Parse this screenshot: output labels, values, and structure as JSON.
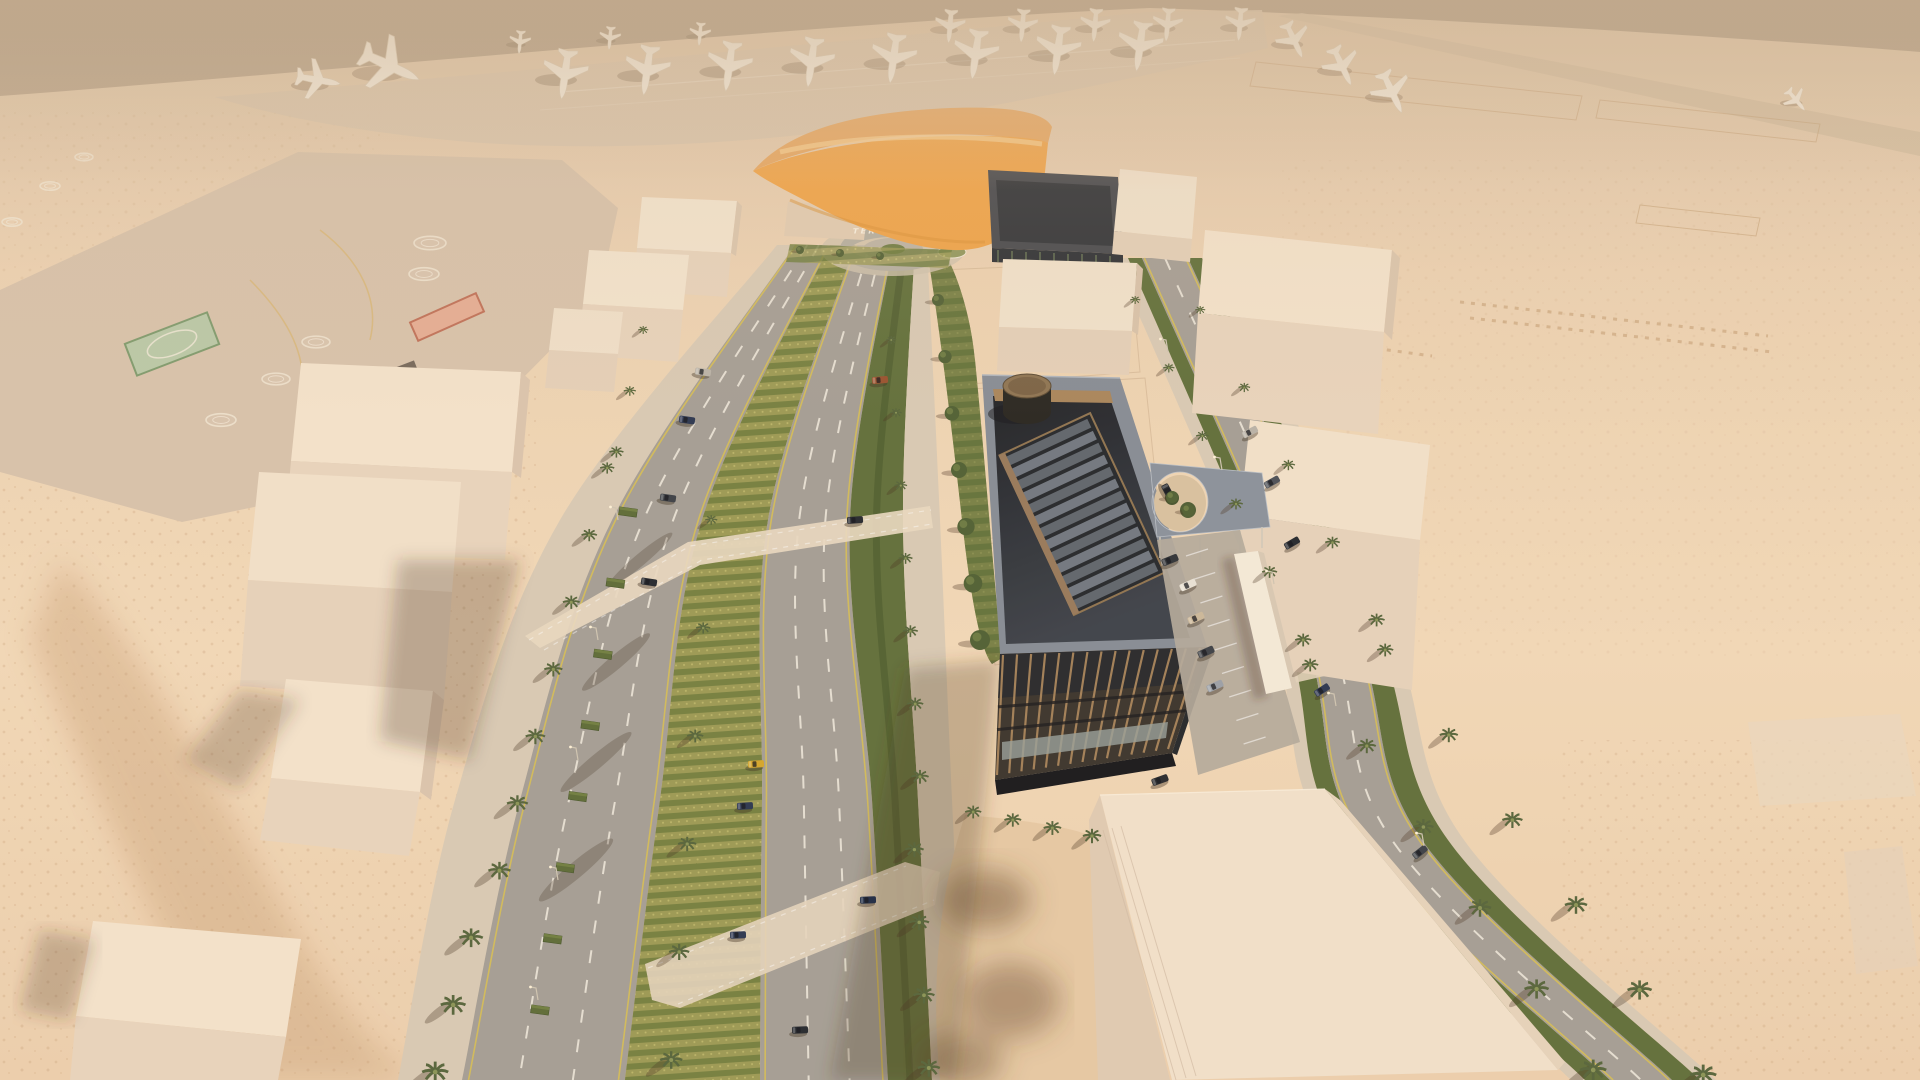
{
  "scene": {
    "description": "Aerial 3D architectural rendering of a desert VIP-terminal district: airport apron with parked aircraft along the horizon, orange VIP terminal canopy, landscaped boulevard with traffic, dark office building with rooftop drum and skylight, helipad apron, and untextured cream massing blocks.",
    "signage": {
      "vip_line1": "VIP",
      "vip_line2": "TERMINAL"
    },
    "palette": {
      "sky_top": "#a18e78",
      "sky_horizon": "#dbc2a4",
      "sand": "#ecd2b2",
      "sand_bright": "#f2d8b8",
      "sand_scrub": "#c79e74",
      "apron": "#d9c5ae",
      "apron_left": "#d7c2ab",
      "road": "#a49e95",
      "road_line_yellow": "#d9c050",
      "road_line_white": "#f5efe2",
      "median_green": "#97914f",
      "median_row_dark": "#6e7c3c",
      "hedge_green": "#5f6e39",
      "palm_green": "#55643a",
      "massing_top": "#f3e4ce",
      "massing_face": "#e7d3bc",
      "massing_side": "#dbc5ad",
      "dark_building": "#39332c",
      "dark_roof": "#23262b",
      "roof_metal": "#858c95",
      "bronze": "#a8845a",
      "glass": "#99a3ad",
      "canopy_orange": "#f0a449",
      "canopy_orange_back": "#e8a65e",
      "canopy_highlight": "#f8cd8e",
      "plane_white": "#f6efe3",
      "concrete": "#d8cab5",
      "shadow": "rgba(70,50,32,0.32)"
    },
    "airport": {
      "plane_rows": [
        {
          "from": [
            565,
            74
          ],
          "to": [
            1140,
            46
          ],
          "count": 8,
          "rot": 188,
          "scale": 1.5
        },
        {
          "from": [
            950,
            26
          ],
          "to": [
            1240,
            24
          ],
          "count": 5,
          "rot": 185,
          "scale": 1.0
        },
        {
          "from": [
            520,
            42
          ],
          "to": [
            700,
            34
          ],
          "count": 3,
          "rot": 185,
          "scale": 0.7
        }
      ],
      "plane_singles": [
        {
          "x": 390,
          "y": 66,
          "rot": 115,
          "scale": 1.9
        },
        {
          "x": 318,
          "y": 80,
          "rot": 100,
          "scale": 1.35
        },
        {
          "x": 1294,
          "y": 40,
          "rot": 155,
          "scale": 1.15
        },
        {
          "x": 1342,
          "y": 66,
          "rot": 155,
          "scale": 1.25
        },
        {
          "x": 1392,
          "y": 92,
          "rot": 155,
          "scale": 1.35
        },
        {
          "x": 1796,
          "y": 100,
          "rot": 140,
          "scale": 0.8
        }
      ]
    },
    "helipads": {
      "circles": [
        [
          430,
          243,
          16
        ],
        [
          424,
          274,
          15
        ],
        [
          316,
          342,
          14
        ],
        [
          276,
          379,
          14
        ],
        [
          221,
          420,
          15
        ],
        [
          84,
          157,
          9
        ],
        [
          50,
          186,
          10
        ],
        [
          12,
          222,
          10
        ]
      ],
      "green_square": {
        "x": 172,
        "y": 344,
        "w": 88,
        "h": 34,
        "rot": -21
      },
      "red_pad": {
        "x": 447,
        "y": 317,
        "w": 72,
        "h": 20,
        "rot": -24
      }
    },
    "boulevard": {
      "anchors_y": [
        245,
        520,
        800,
        1080
      ],
      "edges": {
        "e0": [
          777,
          560,
          455,
          398
        ],
        "e1": [
          795,
          612,
          520,
          462
        ],
        "e2": [
          830,
          702,
          660,
          625
        ],
        "e3": [
          855,
          768,
          762,
          760
        ],
        "e4": [
          893,
          850,
          872,
          888
        ],
        "e5": [
          915,
          903,
          918,
          932
        ],
        "e6": [
          927,
          940,
          952,
          966
        ]
      },
      "lanesA": [
        0.35,
        0.68
      ],
      "lanesB": [
        0.38,
        0.7
      ]
    },
    "right_avenue": {
      "anchors_y": [
        258,
        620,
        840,
        1080
      ],
      "edges": {
        "r0": [
          1128,
          1282,
          1342,
          1585
        ],
        "r1": [
          1142,
          1300,
          1362,
          1610
        ],
        "r2": [
          1188,
          1352,
          1422,
          1672
        ],
        "r3": [
          1202,
          1372,
          1448,
          1700
        ]
      }
    },
    "vehicles": {
      "street_cars": [
        {
          "x": 703,
          "y": 372,
          "rot": 8,
          "color": "#b9b3a8"
        },
        {
          "x": 687,
          "y": 420,
          "rot": 8,
          "color": "#2a3550"
        },
        {
          "x": 668,
          "y": 498,
          "rot": 8,
          "color": "#3a3f46"
        },
        {
          "x": 649,
          "y": 582,
          "rot": 9,
          "color": "#23272e"
        },
        {
          "x": 880,
          "y": 380,
          "rot": -5,
          "color": "#97502d"
        },
        {
          "x": 855,
          "y": 520,
          "rot": -4,
          "color": "#23272e"
        },
        {
          "x": 756,
          "y": 764,
          "rot": -3,
          "color": "#d4a62a"
        },
        {
          "x": 745,
          "y": 806,
          "rot": -3,
          "color": "#2a3550"
        },
        {
          "x": 738,
          "y": 935,
          "rot": -2,
          "color": "#2a3550"
        },
        {
          "x": 868,
          "y": 900,
          "rot": -2,
          "color": "#1d2a44"
        },
        {
          "x": 800,
          "y": 1030,
          "rot": -2,
          "color": "#23272e"
        },
        {
          "x": 1250,
          "y": 432,
          "rot": -27,
          "color": "#b9b3a8"
        },
        {
          "x": 1272,
          "y": 482,
          "rot": -29,
          "color": "#4a4f57"
        },
        {
          "x": 1292,
          "y": 543,
          "rot": -30,
          "color": "#23272e"
        },
        {
          "x": 1322,
          "y": 690,
          "rot": -33,
          "color": "#2a3550"
        },
        {
          "x": 1420,
          "y": 852,
          "rot": -38,
          "color": "#3a3f46"
        }
      ],
      "parked_cars": [
        {
          "x": 1188,
          "y": 585,
          "rot": -24,
          "color": "#e8e2d6"
        },
        {
          "x": 1196,
          "y": 618,
          "rot": -24,
          "color": "#cbb89a"
        },
        {
          "x": 1206,
          "y": 652,
          "rot": -24,
          "color": "#3c4046"
        },
        {
          "x": 1215,
          "y": 686,
          "rot": -24,
          "color": "#9aa0a8"
        },
        {
          "x": 1170,
          "y": 560,
          "rot": -22,
          "color": "#2e3237"
        },
        {
          "x": 1160,
          "y": 780,
          "rot": -20,
          "color": "#26292e"
        },
        {
          "x": 1168,
          "y": 492,
          "rot": 62,
          "color": "#23262b"
        }
      ]
    },
    "vegetation": {
      "palm_rows": [
        {
          "from": [
            648,
            330
          ],
          "to": [
            618,
            452
          ],
          "count": 3,
          "s0": 5,
          "s1": 7
        },
        {
          "from": [
            612,
            468
          ],
          "to": [
            436,
            1072
          ],
          "count": 10,
          "s0": 7,
          "s1": 13
        },
        {
          "from": [
            716,
            520
          ],
          "to": [
            668,
            1060
          ],
          "count": 6,
          "s0": 6,
          "s1": 11
        },
        {
          "from": [
            896,
            340
          ],
          "to": [
            928,
            1068
          ],
          "count": 11,
          "s0": 5,
          "s1": 11
        },
        {
          "from": [
            1140,
            300
          ],
          "to": [
            1300,
            640
          ],
          "count": 6,
          "s0": 5,
          "s1": 8
        },
        {
          "from": [
            1315,
            665
          ],
          "to": [
            1590,
            1070
          ],
          "count": 6,
          "s0": 8,
          "s1": 13
        },
        {
          "from": [
            1205,
            310
          ],
          "to": [
            1375,
            620
          ],
          "count": 5,
          "s0": 5,
          "s1": 8
        },
        {
          "from": [
            1390,
            650
          ],
          "to": [
            1700,
            1075
          ],
          "count": 6,
          "s0": 8,
          "s1": 13
        },
        {
          "from": [
            978,
            812
          ],
          "to": [
            1092,
            836
          ],
          "count": 4,
          "s0": 8,
          "s1": 9
        }
      ],
      "tree_rows": [
        {
          "from": [
            938,
            300
          ],
          "to": [
            980,
            640
          ],
          "count": 7,
          "s0": 6,
          "s1": 10
        },
        {
          "from": [
            1172,
            497
          ],
          "to": [
            1188,
            510
          ],
          "count": 2,
          "s0": 6,
          "s1": 6
        },
        {
          "from": [
            800,
            250
          ],
          "to": [
            880,
            256
          ],
          "count": 3,
          "s0": 4,
          "s1": 4
        }
      ],
      "hedge_boxes": {
        "from": [
          628,
          512
        ],
        "to": [
          540,
          1010
        ],
        "count": 8,
        "w": 18,
        "h": 8,
        "rot": 8
      }
    },
    "street_lights": [
      [
        618,
        520
      ],
      [
        598,
        640
      ],
      [
        578,
        760
      ],
      [
        558,
        880
      ],
      [
        538,
        1000
      ],
      [
        1168,
        352
      ],
      [
        1222,
        470
      ],
      [
        1274,
        584
      ],
      [
        1336,
        706
      ],
      [
        1424,
        846
      ]
    ]
  }
}
